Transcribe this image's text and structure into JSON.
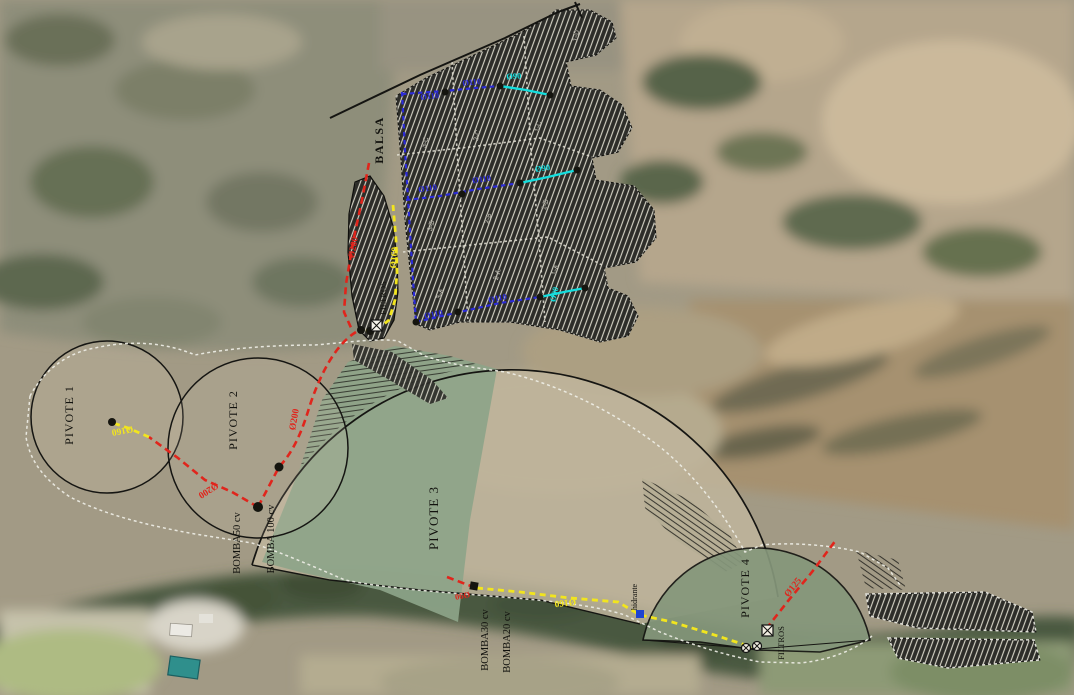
{
  "colors": {
    "red_pipe": "#e0251c",
    "yellow_pipe": "#f2e51e",
    "blue_pipe": "#2b2bd8",
    "cyan_pipe": "#14dede",
    "line_black": "#151512",
    "boundary_white": "#f0efe8",
    "pivot3_green": "#8da489",
    "pivot4_green": "#85977b"
  },
  "plan": {
    "reservoir_label": "BALSA",
    "filters_top_label": "FILTROS",
    "filters_bottom_label": "FILTROS",
    "hydrant_label": "hidrante",
    "pivots": [
      {
        "label": "PIVOTE 1"
      },
      {
        "label": "PIVOTE 2"
      },
      {
        "label": "PIVOTE 3"
      },
      {
        "label": "PIVOTE 4"
      }
    ],
    "pumps": [
      {
        "label": "BOMBA50 cv"
      },
      {
        "label": "BOMBA 100 cv"
      },
      {
        "label": "BOMBA30 cv"
      },
      {
        "label": "BOMBA20 cv"
      }
    ],
    "sectors": [
      {
        "label": "1-D"
      },
      {
        "label": "3-C"
      },
      {
        "label": "2-C"
      },
      {
        "label": "1-C"
      },
      {
        "label": "3-B"
      },
      {
        "label": "2-B"
      },
      {
        "label": "1-B"
      },
      {
        "label": "3-A"
      },
      {
        "label": "2-A"
      },
      {
        "label": "1-A"
      }
    ],
    "pipe_labels": [
      {
        "label": "Ø200"
      },
      {
        "label": "Ø200"
      },
      {
        "label": "Ø200"
      },
      {
        "label": "Ø160"
      },
      {
        "label": "Ø160"
      },
      {
        "label": "Ø160"
      },
      {
        "label": "Ø110"
      },
      {
        "label": "Ø110"
      },
      {
        "label": "Ø110"
      },
      {
        "label": "Ø110"
      },
      {
        "label": "Ø110"
      },
      {
        "label": "Ø110"
      },
      {
        "label": "Ø90"
      },
      {
        "label": "Ø90"
      },
      {
        "label": "Ø90"
      },
      {
        "label": "Ø90"
      },
      {
        "label": "Ø125"
      }
    ]
  }
}
